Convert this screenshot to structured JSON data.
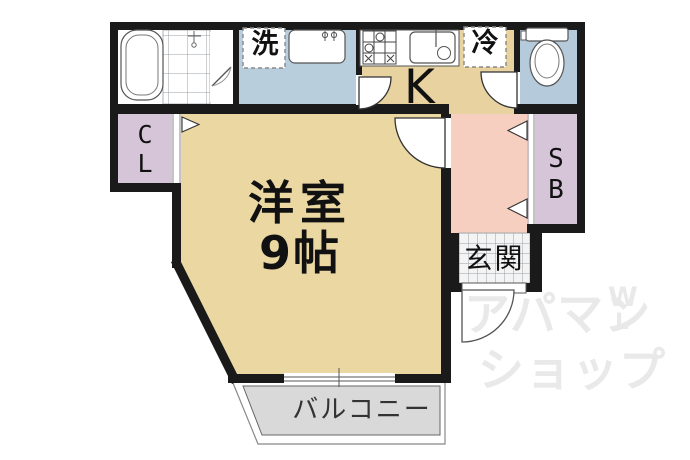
{
  "plan_title": "1K apartment floor plan",
  "labels": {
    "washer": "洗",
    "fridge": "冷",
    "kitchen": "K",
    "closet_chars": [
      "C",
      "L"
    ],
    "shoebox_chars": [
      "S",
      "B"
    ],
    "room_name": "洋室",
    "room_size": "9帖",
    "entrance": "玄関",
    "balcony": "バルコニー"
  },
  "watermark": {
    "line1": "アパマン",
    "line2": "ショップ",
    "logo_top": "W",
    "logo_bottom": "L"
  },
  "colors": {
    "wall": "#1a1a1a",
    "main_room": "#ebd7a2",
    "kitchen": "#e8d2a0",
    "wash_area": "#b9cedd",
    "toilet_room": "#b5cada",
    "closet": "#d6c5d9",
    "shoebox": "#d6c5d9",
    "hallway": "#f7cfc0",
    "balcony": "#d9d9d9",
    "entrance_tile": "#f4f4f4",
    "watermark": "#e9e9e9",
    "fixture_stroke": "#444444"
  },
  "fixtures": [
    "bathtub",
    "shower",
    "washing-machine-space",
    "washbasin",
    "gas-stove",
    "kitchen-sink",
    "refrigerator-space",
    "toilet",
    "window",
    "folding-door-markers",
    "door-swings"
  ]
}
